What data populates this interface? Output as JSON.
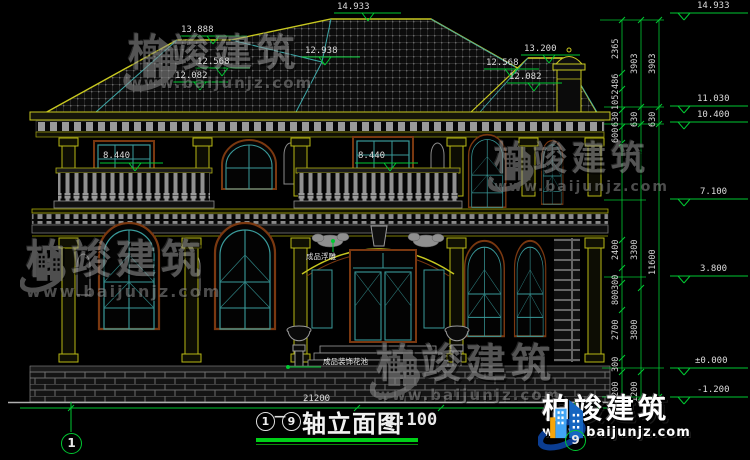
{
  "drawing_title": {
    "axis_from": "1",
    "dash": "—",
    "axis_to": "9",
    "name": "轴立面图",
    "scale": "1:100"
  },
  "axes": {
    "left_bubble": "1",
    "right_bubble": "9"
  },
  "overall_dim": "21200",
  "roof_flags": {
    "f13888": "13.888",
    "f14933": "14.933",
    "f12938": "12.938",
    "f13200": "13.200",
    "f12568L": "12.568",
    "f12082L": "12.082",
    "f12568R": "12.568",
    "f12082R": "12.082"
  },
  "floor_flags": {
    "left": "8.440",
    "right": "8.440"
  },
  "right_flags": {
    "top": "14.933",
    "a": "11.030",
    "b": "10.400",
    "c": "7.100",
    "d": "3.800",
    "e": "±0.000",
    "f": "-1.200"
  },
  "chains": {
    "inner": [
      "2365",
      "486",
      "1052",
      "630",
      "600",
      "2400",
      "300",
      "800",
      "2700",
      "300",
      "1200"
    ],
    "middle": [
      "3903",
      "630",
      "3300",
      "3800",
      "1200"
    ],
    "outer": [
      "3903",
      "630",
      "11600"
    ]
  },
  "callouts": {
    "relief": "成品浮雕",
    "flowerbed": "成品装饰花池"
  },
  "watermark": {
    "brand": "柏竣建筑",
    "url": "www.baijunjz.com"
  },
  "logo": {
    "brand": "柏竣建筑",
    "url": "www.baijunjz.com"
  },
  "colors": {
    "dim_green": "#00c832",
    "outline_yellow": "#c8c820",
    "frame_teal": "#3a9a9a",
    "frame_brown": "#7a3810",
    "logo_blue": "#1565c0",
    "logo_orange": "#f6a60a"
  }
}
